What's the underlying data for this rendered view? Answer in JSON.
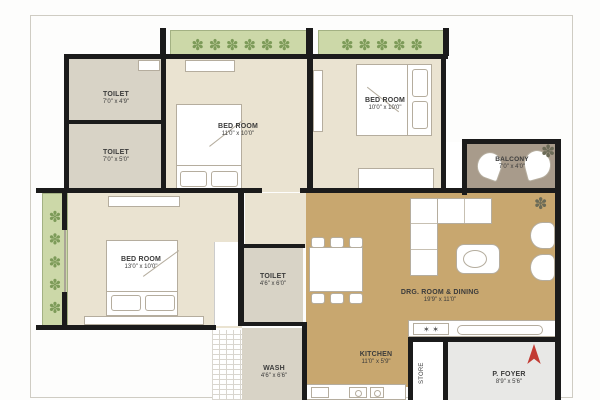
{
  "rooms": {
    "toilet_top": {
      "name": "TOILET",
      "dims": "7'0\" x 4'9\""
    },
    "toilet_mid": {
      "name": "TOILET",
      "dims": "7'0\" x 5'0\""
    },
    "bedroom_center": {
      "name": "BED ROOM",
      "dims": "11'0\" x 10'0\""
    },
    "bedroom_right": {
      "name": "BED ROOM",
      "dims": "10'0\" x 10'0\""
    },
    "balcony": {
      "name": "BALCONY",
      "dims": "7'0\" x 4'0\""
    },
    "bedroom_left": {
      "name": "BED ROOM",
      "dims": "13'0\" x 10'0\""
    },
    "toilet_inner": {
      "name": "TOILET",
      "dims": "4'6\" x 6'0\""
    },
    "wash": {
      "name": "WASH",
      "dims": "4'6\" x 6'6\""
    },
    "drg_dining": {
      "name": "DRG. ROOM & DINING",
      "dims": "19'9\" x 11'0\""
    },
    "kitchen": {
      "name": "KITCHEN",
      "dims": "11'0\" x 5'9\""
    },
    "store": {
      "name": "STORE"
    },
    "foyer": {
      "name": "P. FOYER",
      "dims": "8'9\" x 5'6\""
    }
  },
  "icons": {
    "plant_row_long": "✽ ✽ ✽ ✽ ✽ ✽",
    "plant_row_short": "✽ ✽ ✽ ✽ ✽",
    "plant_column": "✽ ✽ ✽ ✽ ✽",
    "plant_single": "✽",
    "burners": "✶ ✶"
  },
  "colors": {
    "wall": "#1b1b1b",
    "bedroom": "#eae3d1",
    "toilet": "#d8d3c6",
    "living": "#c8a76f",
    "balcony": "#a89b8b",
    "foyer": "#e8e8e6",
    "planter": "#ccd8a8",
    "plant": "#7d9b59",
    "north_arrow": "#c23b33"
  }
}
